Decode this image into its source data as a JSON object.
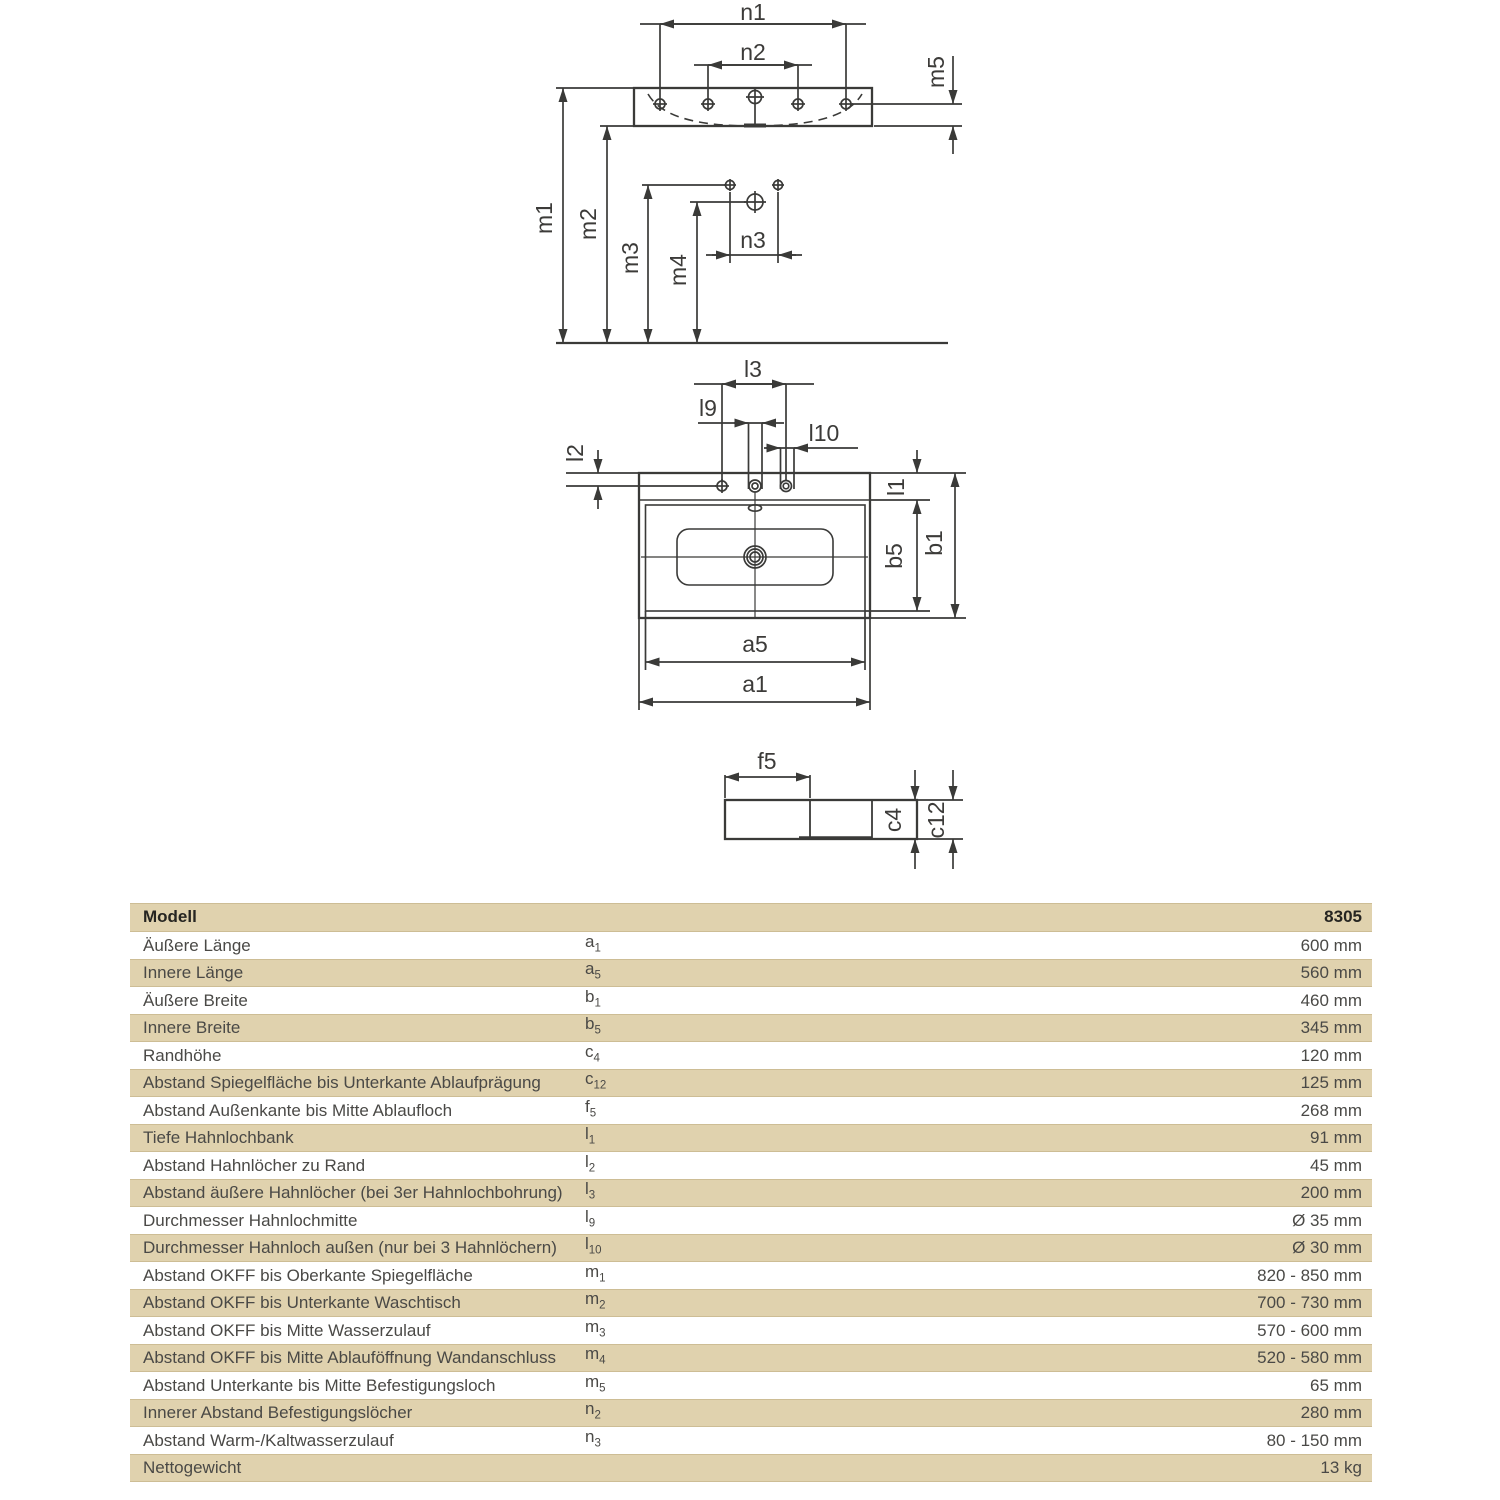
{
  "diagram": {
    "front_labels": {
      "n1": "n1",
      "n2": "n2",
      "m5": "m5",
      "m1": "m1",
      "m2": "m2",
      "m3": "m3",
      "m4": "m4",
      "n3": "n3"
    },
    "top_labels": {
      "l3": "l3",
      "l9": "l9",
      "l10": "l10",
      "l2": "l2",
      "l1": "l1",
      "b5": "b5",
      "b1": "b1",
      "a5": "a5",
      "a1": "a1"
    },
    "side_labels": {
      "f5": "f5",
      "c4": "c4",
      "c12": "c12"
    }
  },
  "table": {
    "header": {
      "label": "Modell",
      "value": "8305"
    },
    "rows": [
      {
        "label": "Äußere Länge",
        "sym": "a",
        "sub": "1",
        "value": "600 mm"
      },
      {
        "label": "Innere Länge",
        "sym": "a",
        "sub": "5",
        "value": "560 mm"
      },
      {
        "label": "Äußere Breite",
        "sym": "b",
        "sub": "1",
        "value": "460 mm"
      },
      {
        "label": "Innere Breite",
        "sym": "b",
        "sub": "5",
        "value": "345 mm"
      },
      {
        "label": "Randhöhe",
        "sym": "c",
        "sub": "4",
        "value": "120 mm"
      },
      {
        "label": "Abstand Spiegelfläche bis Unterkante Ablaufprägung",
        "sym": "c",
        "sub": "12",
        "value": "125 mm"
      },
      {
        "label": "Abstand Außenkante bis Mitte Ablaufloch",
        "sym": "f",
        "sub": "5",
        "value": "268 mm"
      },
      {
        "label": "Tiefe Hahnlochbank",
        "sym": "l",
        "sub": "1",
        "value": "91 mm"
      },
      {
        "label": "Abstand Hahnlöcher zu Rand",
        "sym": "l",
        "sub": "2",
        "value": "45 mm"
      },
      {
        "label": "Abstand äußere Hahnlöcher (bei 3er Hahnlochbohrung)",
        "sym": "l",
        "sub": "3",
        "value": "200 mm"
      },
      {
        "label": "Durchmesser Hahnlochmitte",
        "sym": "l",
        "sub": "9",
        "value": "Ø 35 mm"
      },
      {
        "label": "Durchmesser Hahnloch außen (nur bei 3 Hahnlöchern)",
        "sym": "l",
        "sub": "10",
        "value": "Ø 30 mm"
      },
      {
        "label": "Abstand OKFF bis Oberkante Spiegelfläche",
        "sym": "m",
        "sub": "1",
        "value": "820 - 850 mm"
      },
      {
        "label": "Abstand OKFF bis Unterkante Waschtisch",
        "sym": "m",
        "sub": "2",
        "value": "700 - 730 mm"
      },
      {
        "label": "Abstand OKFF bis Mitte Wasserzulauf",
        "sym": "m",
        "sub": "3",
        "value": "570 - 600 mm"
      },
      {
        "label": "Abstand OKFF bis Mitte Ablauföffnung Wandanschluss",
        "sym": "m",
        "sub": "4",
        "value": "520 - 580 mm"
      },
      {
        "label": "Abstand Unterkante bis Mitte Befestigungsloch",
        "sym": "m",
        "sub": "5",
        "value": "65 mm"
      },
      {
        "label": "Innerer Abstand Befestigungslöcher",
        "sym": "n",
        "sub": "2",
        "value": "280 mm"
      },
      {
        "label": "Abstand Warm-/Kaltwasserzulauf",
        "sym": "n",
        "sub": "3",
        "value": "80 - 150 mm"
      },
      {
        "label": "Nettogewicht",
        "sym": "",
        "sub": "",
        "value": "13 kg"
      }
    ]
  },
  "colors": {
    "row_tint": "#e0d2ae",
    "row_tint_border": "#cdbd95",
    "line": "#3a3a38",
    "text": "#4a4946"
  }
}
